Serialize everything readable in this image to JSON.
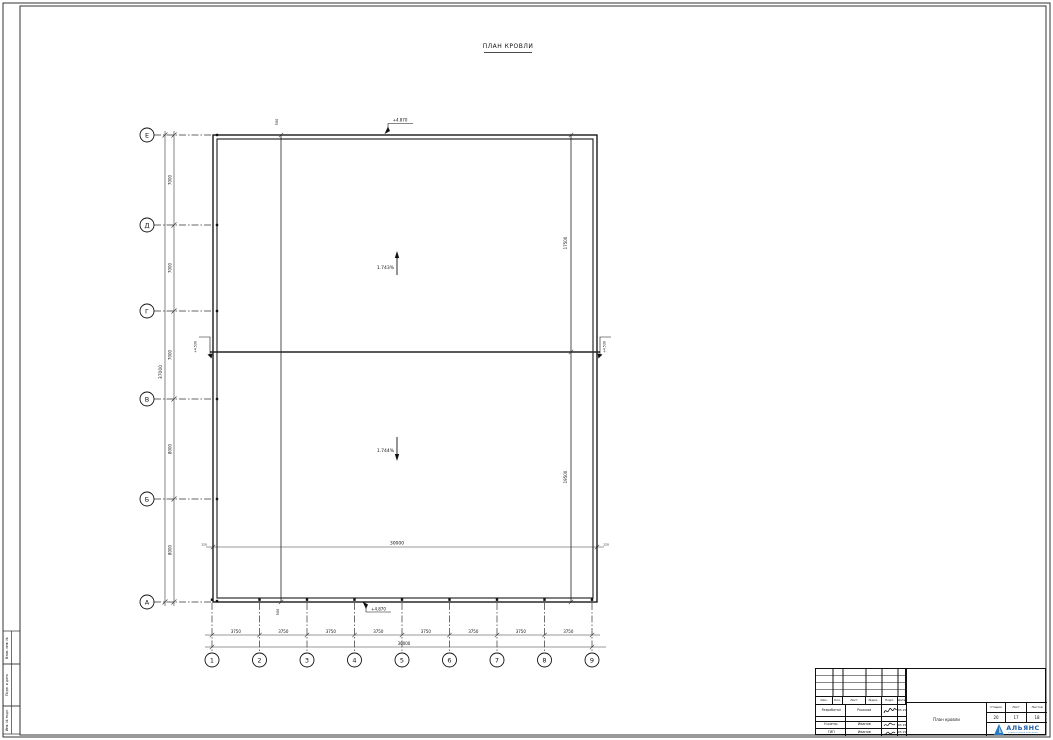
{
  "sheet": {
    "title": "ПЛАН КРОВЛИ"
  },
  "axes": {
    "horizontal": [
      "Е",
      "Д",
      "Г",
      "В",
      "Б",
      "А"
    ],
    "vertical": [
      "1",
      "2",
      "3",
      "4",
      "5",
      "6",
      "7",
      "8",
      "9"
    ]
  },
  "dimensions": {
    "left_total": "37000",
    "left_segments": [
      "7000",
      "7000",
      "7000",
      "8000",
      "8000"
    ],
    "bottom_segments": [
      "3750",
      "3750",
      "3750",
      "3750",
      "3750",
      "3750",
      "3750",
      "3750"
    ],
    "bottom_total": "30000",
    "mid_total": "30000",
    "mid_end_left": "120",
    "mid_end_right": "120",
    "right_upper": "17500",
    "right_lower": "19500",
    "offset_top": "500",
    "offset_bottom": "500"
  },
  "annotations": {
    "slope_upper": "1.743%",
    "slope_lower": "1.744%",
    "level_top": "+4.870",
    "level_bottom": "+4.870",
    "level_mid_left": "+4.530",
    "level_mid_right": "+4.530"
  },
  "margin_boxes": [
    "Взам. инв. №",
    "Подп. и дата",
    "Инв. № подл."
  ],
  "title_block": {
    "header_cols": [
      "Изм.",
      "Кол.",
      "Лист",
      "№док.",
      "Подп.",
      "Дата"
    ],
    "rows": [
      {
        "role": "Разработал",
        "name": "Рыжков",
        "date": "03.15"
      },
      {
        "role": "",
        "name": "",
        "date": ""
      },
      {
        "role": "Н.контр.",
        "name": "Иванов",
        "date": "03.15"
      },
      {
        "role": "ГИП",
        "name": "Иванов",
        "date": "03.15"
      }
    ],
    "drawing_title": "План кровли",
    "stage_label": "Стадия",
    "sheet_label": "Лист",
    "sheets_label": "Листов",
    "stage_value": "20",
    "sheet_value": "17",
    "sheets_value": "18",
    "company": "АЛЬЯНС",
    "company_sub": "строительная компания",
    "logo_color": "#2878be"
  }
}
